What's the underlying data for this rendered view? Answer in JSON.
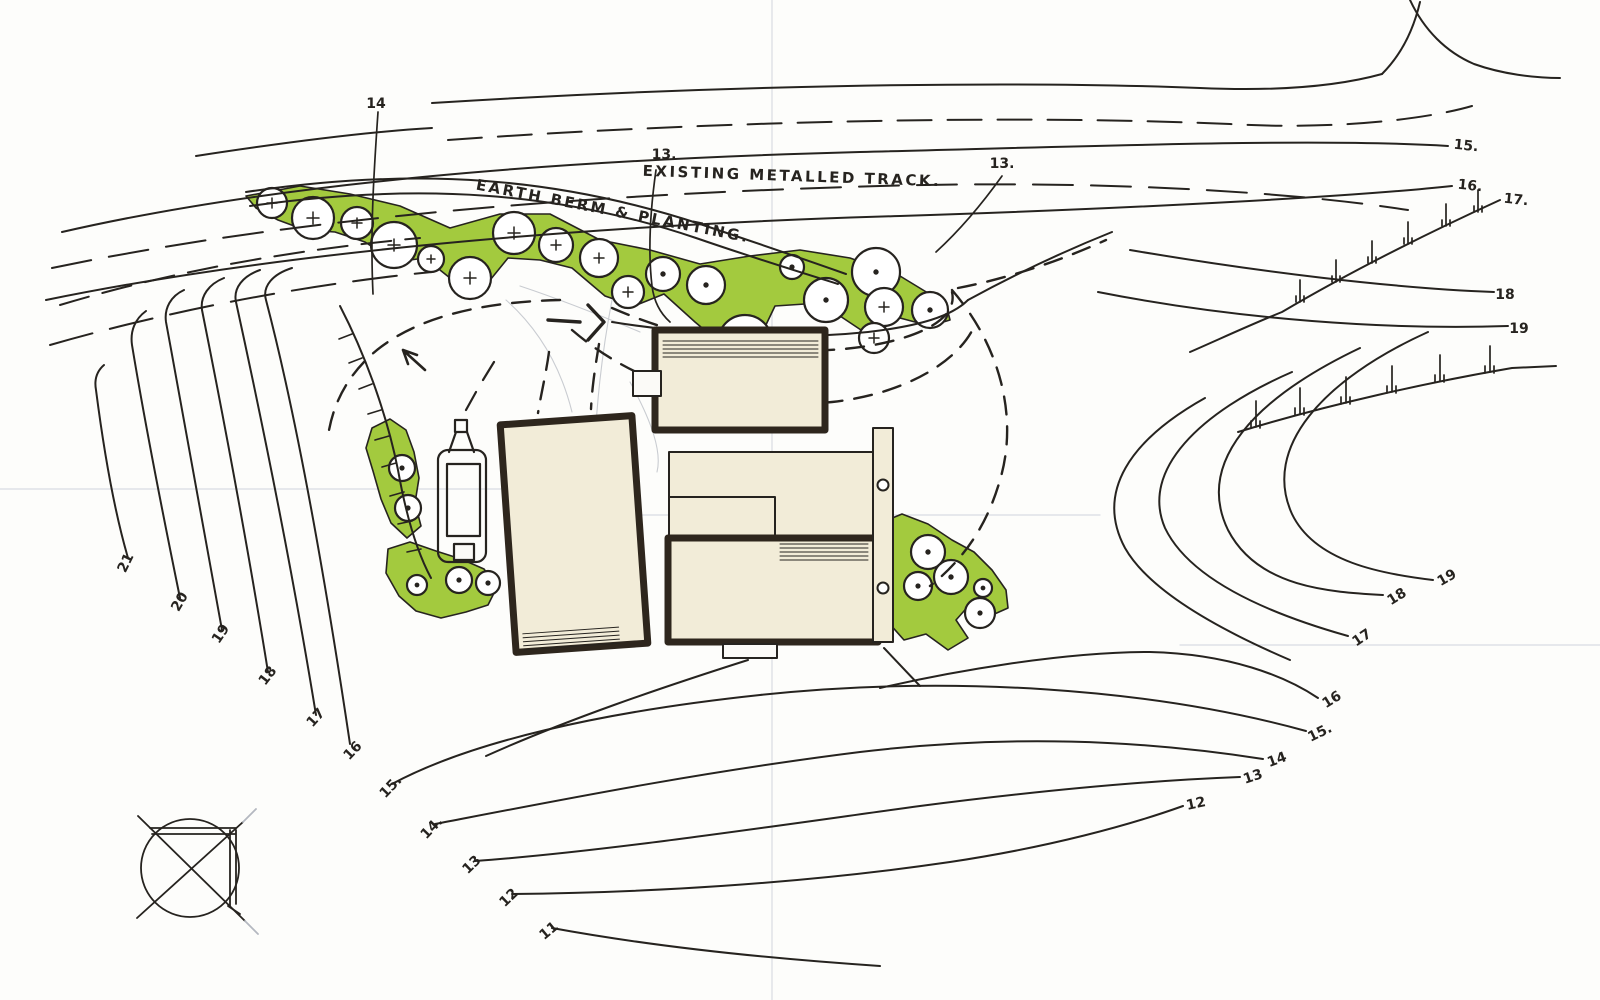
{
  "annotations": {
    "existing_track": "EXISTING METALLED TRACK.",
    "earth_berm": "EARTH BERM & PLANTING."
  },
  "contour_labels": {
    "top": [
      "14",
      "13.",
      "13."
    ],
    "top_right": [
      "15.",
      "16.",
      "17.",
      "18",
      "19"
    ],
    "left": [
      "21",
      "20",
      "19",
      "18",
      "17",
      "16",
      "15.",
      "14.",
      "13",
      "12",
      "11"
    ],
    "bottom_right": [
      "19",
      "18",
      "17",
      "16",
      "15.",
      "14",
      "13",
      "12"
    ]
  },
  "icons": {
    "north_indicator": "compass-circle-icon",
    "tree": "tree-canopy-icon",
    "fence": "fence-post-icon",
    "vehicle": "trailer-plan-icon"
  },
  "colors": {
    "paper": "#fdfdfb",
    "ink": "#26231f",
    "green": "#a3ca3e",
    "building_fill": "#f2ecd8",
    "wall": "#2e261d",
    "fold_line": "#d9dce2",
    "pencil": "#b4b8c0"
  }
}
